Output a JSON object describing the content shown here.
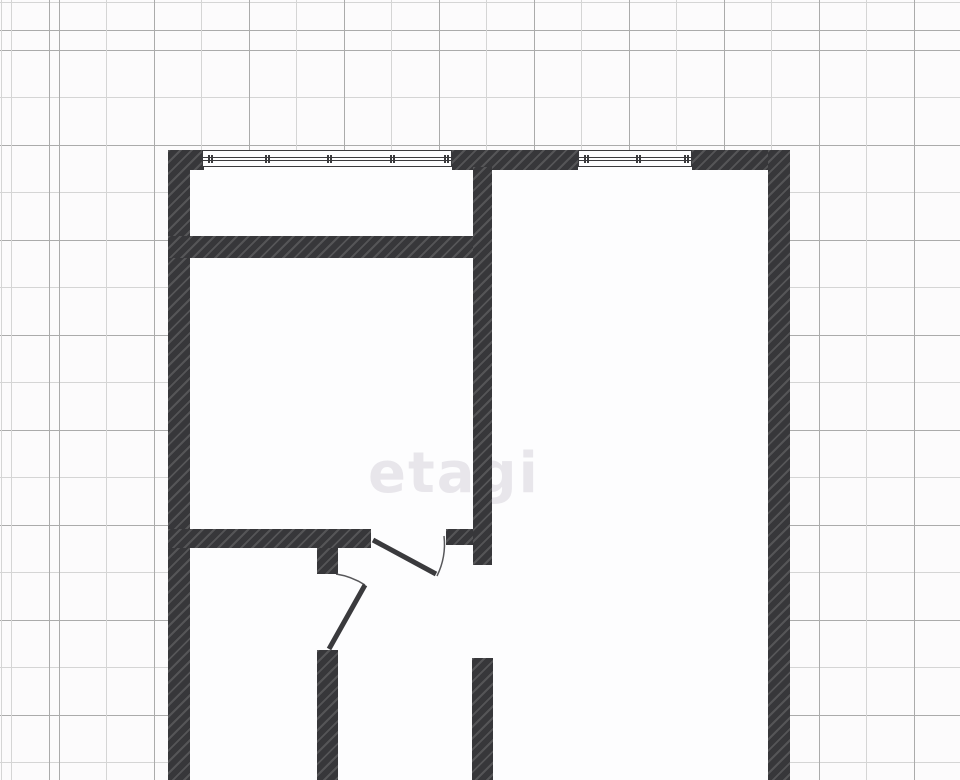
{
  "meta": {
    "width": 960,
    "height": 780,
    "kind": "apartment-floor-plan-on-grid-paper"
  },
  "watermark": {
    "text": "etagi"
  },
  "palette": {
    "wall": "#37373a",
    "wall_hatch": "rgba(255,255,255,0.15)",
    "line": "#3a3a3d",
    "grid_dark": "#ababab",
    "grid_light": "#d5d5d5",
    "paper": "#fcfbfc",
    "room": "#fdfdfe",
    "watermark": "rgba(140,130,152,0.18)"
  },
  "grid": {
    "cell": 47.5,
    "alternating_line_period": 95
  },
  "floorplan": {
    "bounds": {
      "x": 168,
      "y": 150,
      "w": 622,
      "h": 630
    },
    "walls": [
      {
        "name": "wall-left",
        "x": 168,
        "y": 150,
        "w": 22,
        "h": 630
      },
      {
        "name": "wall-top-left-corner",
        "x": 168,
        "y": 150,
        "w": 36,
        "h": 20
      },
      {
        "name": "wall-top-between-windows",
        "x": 452,
        "y": 150,
        "w": 126,
        "h": 20
      },
      {
        "name": "wall-top-right",
        "x": 692,
        "y": 150,
        "w": 98,
        "h": 20
      },
      {
        "name": "wall-right",
        "x": 768,
        "y": 150,
        "w": 22,
        "h": 630
      },
      {
        "name": "wall-balcony-divider",
        "x": 168,
        "y": 236,
        "w": 324,
        "h": 22
      },
      {
        "name": "wall-interior-vertical",
        "x": 473,
        "y": 167,
        "w": 19,
        "h": 398
      },
      {
        "name": "wall-hallway-horizontal",
        "x": 168,
        "y": 529,
        "w": 203,
        "h": 19
      },
      {
        "name": "wall-hallway-stub",
        "x": 446,
        "y": 529,
        "w": 27,
        "h": 16
      },
      {
        "name": "wall-bathroom-upper-stub",
        "x": 317,
        "y": 548,
        "w": 21,
        "h": 26
      },
      {
        "name": "wall-bathroom-lower",
        "x": 317,
        "y": 650,
        "w": 21,
        "h": 130
      },
      {
        "name": "wall-interior-vertical-lower",
        "x": 472,
        "y": 658,
        "w": 21,
        "h": 122
      }
    ],
    "windows": [
      {
        "name": "window-left",
        "x": 202,
        "y": 150,
        "w": 250,
        "h": 17,
        "ticks": [
          5,
          62,
          124,
          187,
          241
        ]
      },
      {
        "name": "window-right",
        "x": 578,
        "y": 150,
        "w": 114,
        "h": 17,
        "ticks": [
          5,
          57,
          105
        ]
      }
    ],
    "doors": [
      {
        "name": "door-hallway",
        "leaf": {
          "x1": 373,
          "y1": 540,
          "x2": 436,
          "y2": 574
        },
        "arc": "M 444 536 A 72 72 0 0 1 437 576"
      },
      {
        "name": "door-bathroom",
        "leaf": {
          "x1": 329,
          "y1": 649,
          "x2": 365,
          "y2": 585
        },
        "arc": "M 336 574 A 74 74 0 0 1 365 585"
      }
    ]
  }
}
